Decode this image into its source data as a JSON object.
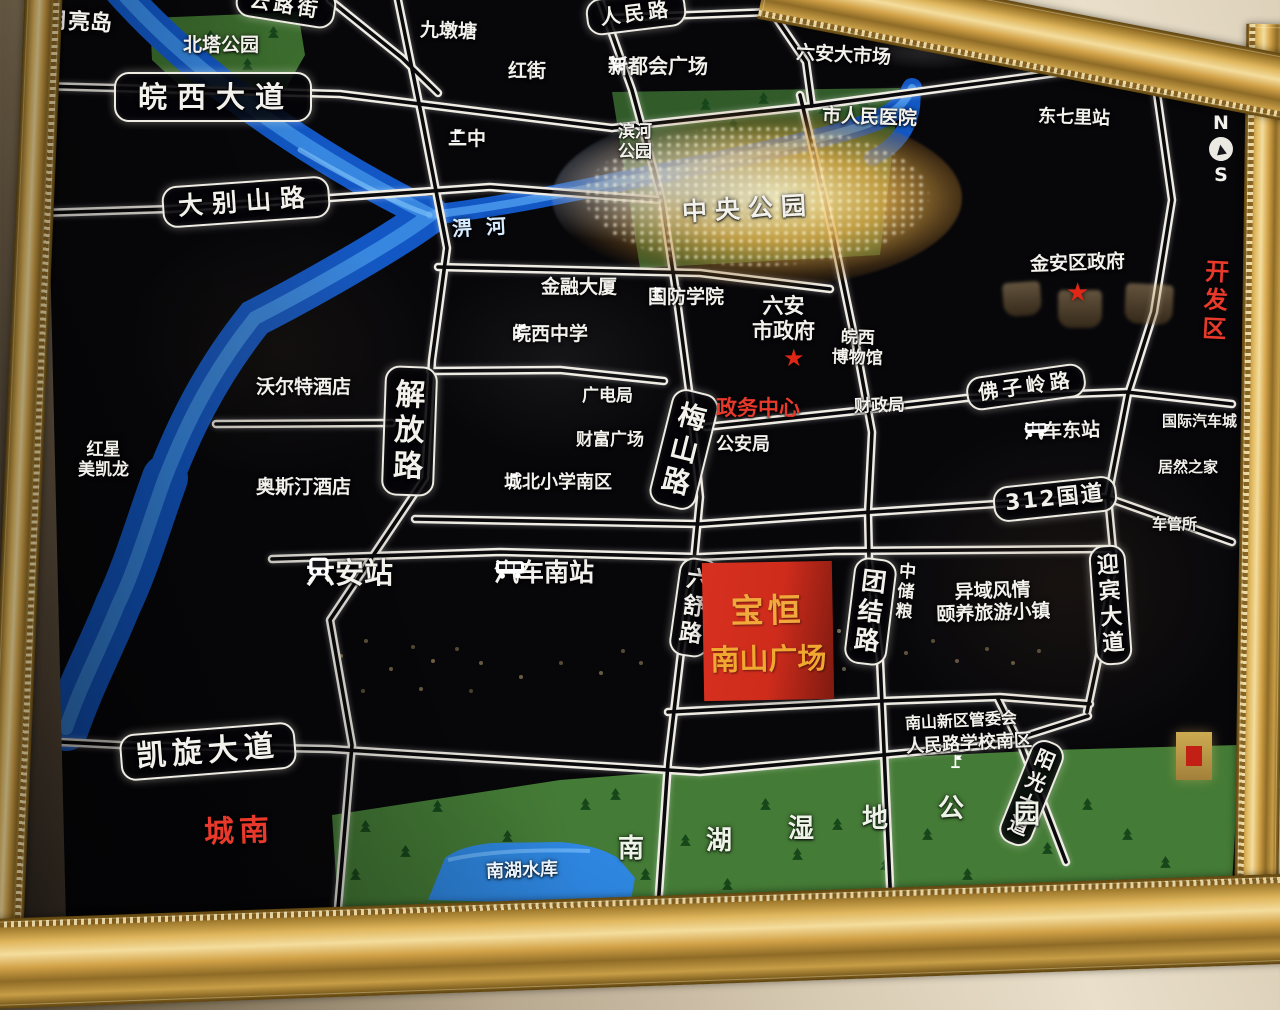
{
  "compass": {
    "n": "N",
    "s": "S",
    "needle": "▲"
  },
  "marks": {
    "star": "★"
  },
  "river_label": "淠河",
  "roads": {
    "wanxi": "皖西大道",
    "dabieshan": "大别山路",
    "kaixuan": "凯旋大道",
    "g312": "312国道",
    "foziling": "佛子岭路",
    "renmin": "人民路",
    "yunlu": "云路街",
    "jiefang": "解放路",
    "meishan": "梅山路",
    "liushu": "六舒路",
    "tuanjie": "团结路",
    "yingbin": "迎宾大道",
    "yangguang": "阳光大道"
  },
  "places": {
    "yueliangdao": "月亮岛",
    "beitagongyuan": "北塔公园",
    "jiuduntang": "九墩塘",
    "hongjie": "红街",
    "xinduhui": "新都会广场",
    "erzhong": "二中",
    "dashichang": "六安大市场",
    "renminyiyuan": "市人民医院",
    "dongqilizhan": "东七里站",
    "binhe_l1": "滨河",
    "binhe_l2": "公园",
    "zhongyanggongyuan": "中央公园",
    "jinrongdasha": "金融大厦",
    "guofangxueyuan": "国防学院",
    "shizhengfu_l1": "六安",
    "shizhengfu_l2": "市政府",
    "bowuguan_l1": "皖西",
    "bowuguan_l2": "博物馆",
    "wanxizhongxue": "皖西中学",
    "jinanquzhengfu": "金安区政府",
    "kaifaqu": "开发区",
    "woertejiudian": "沃尔特酒店",
    "aositingjiudian": "奥斯汀酒店",
    "hongxing_l1": "红星",
    "hongxing_l2": "美凯龙",
    "guangdianju": "广电局",
    "caifuguangchang": "财富广场",
    "zhengwuzhongxin": "政务中心",
    "gonganju": "公安局",
    "caizhengju": "财政局",
    "qichedongzhan": "汽车东站",
    "guojiqicheng": "国际汽车城",
    "juranzhijia": "居然之家",
    "cheguansuo": "车管所",
    "chengbeixiaoxue": "城北小学南区",
    "liuanzhan": "六安站",
    "qichenanzhan": "汽车南站",
    "zhongchuliang": "中储粮",
    "yiyufengqing": "异域风情",
    "yiyanglvyou": "颐养旅游小镇",
    "guanweihui": "南山新区管委会",
    "renminluxuexiao": "人民路学校南区",
    "shuiku": "南湖水库",
    "chengnan": "城南"
  },
  "wetland": [
    "南",
    "湖",
    "湿",
    "地",
    "公",
    "园"
  ],
  "plaza": {
    "line1": "宝恒",
    "line2": "南山广场"
  },
  "colors": {
    "red_accent": "#e8392b",
    "plaza_red": "#d63020",
    "plaza_text": "#f2a93c",
    "river_blue": "#2f86e8",
    "park_green": "#3f7d33",
    "frame_gold": "#d9a94e"
  }
}
